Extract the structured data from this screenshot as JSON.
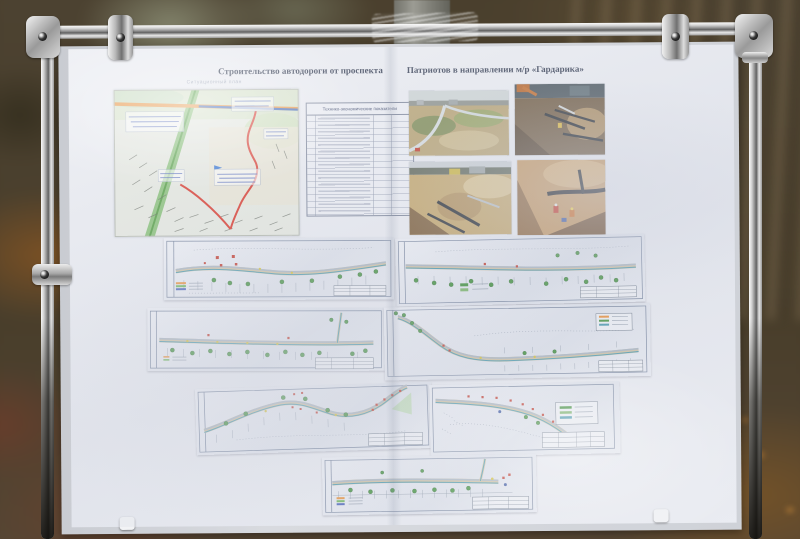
{
  "poster": {
    "title_part1": "Строительство автодороги от проспекта",
    "title_part2": "Патриотов в направлении м/р «Гардарика»",
    "map_caption": "Ситуационный план",
    "table_title": "Технико-экономические показатели"
  },
  "colors": {
    "title_navy": "#333c52",
    "route_red": "#d8362a",
    "marker_red": "#c23b2e",
    "tree_green": "#44923f",
    "road_orange": "#e8913c",
    "highway_blue": "#3f66b5",
    "corridor_green": "#6db45a",
    "label_blue": "#4a63b8",
    "plan_teal": "#4a99ae",
    "band_tan": "#cdbf9e"
  }
}
